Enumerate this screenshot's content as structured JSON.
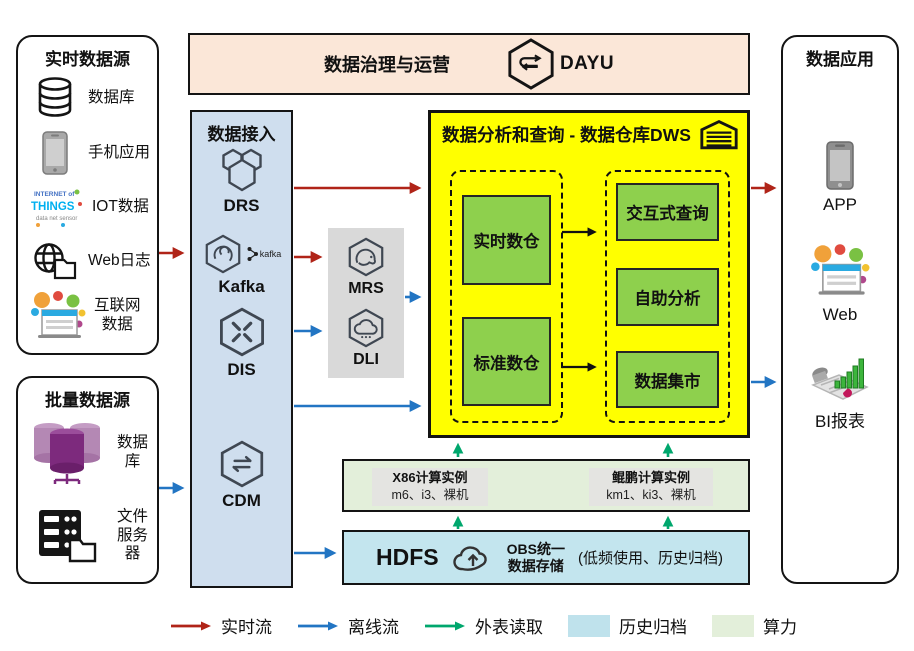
{
  "banner": {
    "title": "数据治理与运营",
    "product": "DAYU"
  },
  "realtime_sources": {
    "title": "实时数据源",
    "items": [
      {
        "icon": "database-icon",
        "label": "数据库"
      },
      {
        "icon": "mobile-app-icon",
        "label": "手机应用"
      },
      {
        "icon": "iot-icon",
        "label": "IOT数据"
      },
      {
        "icon": "weblog-icon",
        "label": "Web日志"
      },
      {
        "icon": "internet-data-icon",
        "label": "互联网\n数据"
      }
    ]
  },
  "batch_sources": {
    "title": "批量数据源",
    "items": [
      {
        "icon": "purple-database-icon",
        "label": "数据库"
      },
      {
        "icon": "file-server-icon",
        "label": "文件\n服务器"
      }
    ]
  },
  "ingest": {
    "title": "数据接入",
    "services": [
      {
        "name": "DRS",
        "icon": "drs-icon"
      },
      {
        "name": "Kafka",
        "icon": "kafka-icon",
        "badge": "kafka"
      },
      {
        "name": "DIS",
        "icon": "dis-icon"
      },
      {
        "name": "CDM",
        "icon": "cdm-icon"
      }
    ]
  },
  "compute_engines": {
    "services": [
      {
        "name": "MRS",
        "icon": "mrs-icon"
      },
      {
        "name": "DLI",
        "icon": "dli-icon"
      }
    ]
  },
  "dws": {
    "title": "数据分析和查询 - 数据仓库DWS",
    "warehouses": [
      {
        "label": "实时数仓"
      },
      {
        "label": "标准数仓"
      }
    ],
    "services": [
      {
        "label": "交互式查询"
      },
      {
        "label": "自助分析"
      },
      {
        "label": "数据集市"
      }
    ]
  },
  "compute_pool": {
    "instances": [
      {
        "name": "X86计算实例",
        "spec": "m6、i3、裸机"
      },
      {
        "name": "鲲鹏计算实例",
        "spec": "km1、ki3、裸机"
      }
    ]
  },
  "storage": {
    "hdfs": "HDFS",
    "obs": "OBS统一\n数据存储",
    "note": "(低频使用、历史归档)"
  },
  "applications": {
    "title": "数据应用",
    "items": [
      {
        "icon": "app-icon",
        "label": "APP"
      },
      {
        "icon": "web-icon",
        "label": "Web"
      },
      {
        "icon": "bi-icon",
        "label": "BI报表"
      }
    ]
  },
  "legend": {
    "items": [
      {
        "type": "arrow",
        "color": "#b02418",
        "label": "实时流"
      },
      {
        "type": "arrow",
        "color": "#2275c3",
        "label": "离线流"
      },
      {
        "type": "arrow",
        "color": "#00a76d",
        "label": "外表读取"
      },
      {
        "type": "swatch",
        "color": "#bfe2ec",
        "label": "历史归档"
      },
      {
        "type": "swatch",
        "color": "#e3efda",
        "label": "算力"
      }
    ]
  },
  "palette": {
    "realtime_flow": "#b02418",
    "offline_flow": "#2275c3",
    "external_read": "#00a76d",
    "dws_bg": "#ffff00",
    "warehouse_green": "#8ed04d",
    "ingest_bg": "#cfdeee",
    "banner_bg": "#fbe7d8",
    "history_archive_bg": "#c3e5ee",
    "compute_bg": "#e3efda",
    "engine_panel_bg": "#d9d9d9"
  }
}
